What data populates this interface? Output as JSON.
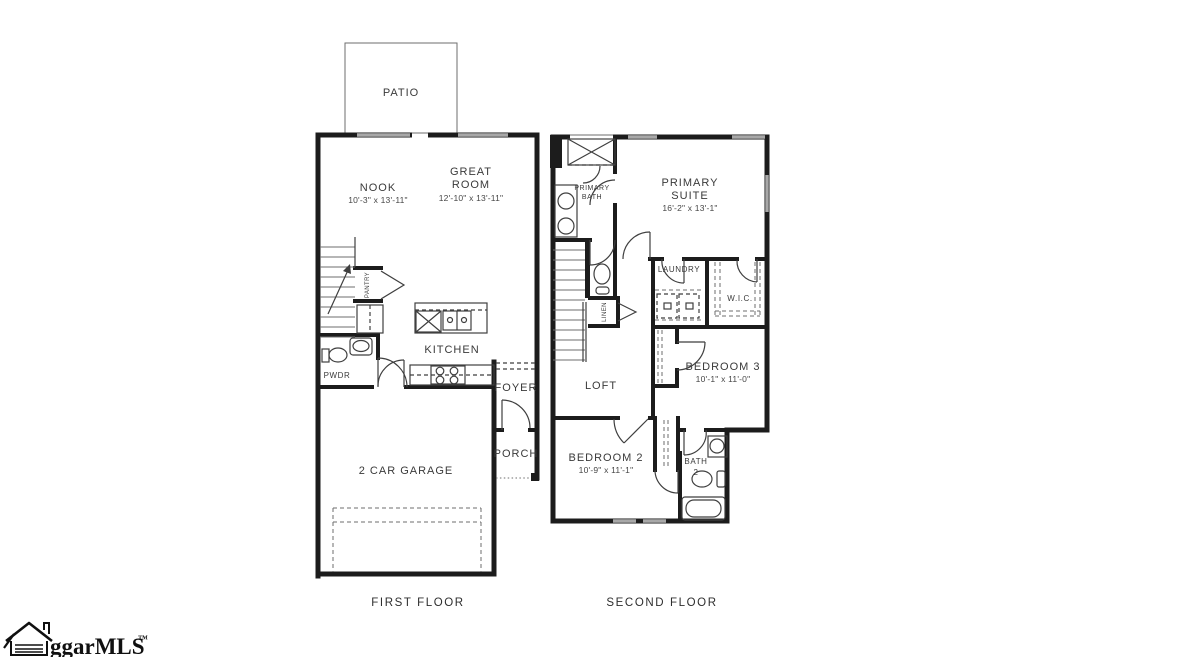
{
  "colors": {
    "wall": "#1c1c1c",
    "window": "#a8a8a8",
    "text": "#3a3a3a",
    "logo_text": "#101010"
  },
  "first_floor": {
    "caption": "FIRST FLOOR",
    "patio_label": "PATIO",
    "nook_label": "NOOK",
    "nook_dims": "10'-3\" x 13'-11\"",
    "great_room_label_1": "GREAT",
    "great_room_label_2": "ROOM",
    "great_room_dims": "12'-10\" x 13'-11\"",
    "pantry_label": "PANTRY",
    "pwdr_label": "PWDR",
    "kitchen_label": "KITCHEN",
    "foyer_label": "FOYER",
    "porch_label": "PORCH",
    "garage_label": "2 CAR GARAGE"
  },
  "second_floor": {
    "caption": "SECOND FLOOR",
    "primary_bath_label_1": "PRIMARY",
    "primary_bath_label_2": "BATH",
    "primary_suite_label_1": "PRIMARY",
    "primary_suite_label_2": "SUITE",
    "primary_suite_dims": "16'-2\" x 13'-1\"",
    "laundry_label": "LAUNDRY",
    "wic_label": "W.I.C.",
    "linen_label": "LINEN",
    "loft_label": "LOFT",
    "bedroom3_label": "BEDROOM 3",
    "bedroom3_dims": "10'-1\" x 11'-0\"",
    "bedroom2_label": "BEDROOM 2",
    "bedroom2_dims": "10'-9\" x 11'-1\"",
    "bath2_label_1": "BATH",
    "bath2_label_2": "2"
  },
  "logo": {
    "text": "ggarMLS",
    "tm": "™"
  }
}
